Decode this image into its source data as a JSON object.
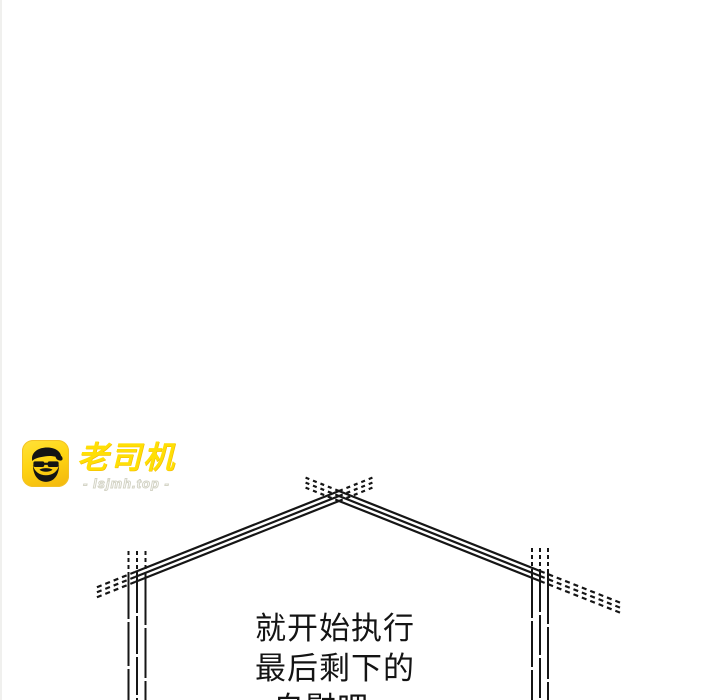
{
  "watermark": {
    "brand": "老司机",
    "site": "- lsjmh.top -",
    "icon_name": "driver-face-icon",
    "icon_bg_color": "#FFD512",
    "brand_color": "#FFDF05",
    "face_color": "#141414"
  },
  "dialogue": {
    "lines": [
      "就开始执行",
      "最后剩下的",
      "自慰吧"
    ],
    "text_color": "#141414"
  },
  "artwork": {
    "name": "house-gable-sketch",
    "stroke_color": "#161616"
  }
}
